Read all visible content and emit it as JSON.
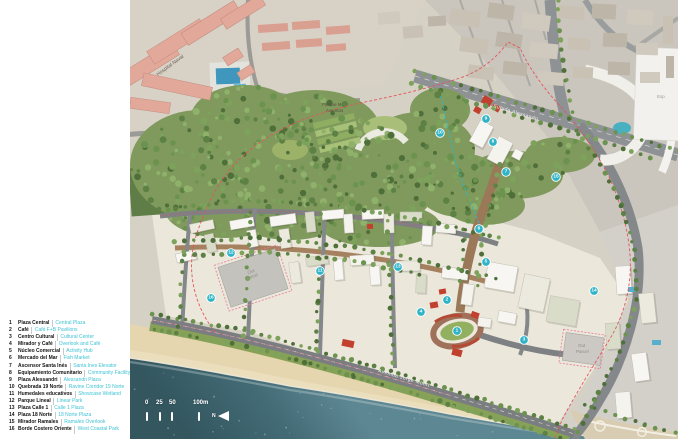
{
  "legend": {
    "items": [
      {
        "num": "1",
        "name": "Plaza Central",
        "en": "Central Plaza"
      },
      {
        "num": "2",
        "name": "Café",
        "en": "Café F+B Pavilions"
      },
      {
        "num": "3",
        "name": "Centro Cultural",
        "en": "Cultural Center"
      },
      {
        "num": "4",
        "name": "Mirador y Café",
        "en": "Overlook and Café"
      },
      {
        "num": "5",
        "name": "Núcleo Comercial",
        "en": "Activity Hub"
      },
      {
        "num": "6",
        "name": "Mercado del Mar",
        "en": "Fish Market"
      },
      {
        "num": "7",
        "name": "Ascensor Santa Inés",
        "en": "Santa Ines Elevator"
      },
      {
        "num": "8",
        "name": "Equipamiento Comunitario",
        "en": "Community Facility"
      },
      {
        "num": "9",
        "name": "Plaza Alessandri",
        "en": "Alessandri Plaza"
      },
      {
        "num": "10",
        "name": "Quebrada 19 Norte",
        "en": "Ravine Corridor 19 Norte"
      },
      {
        "num": "11",
        "name": "Humedales educativos",
        "en": "Showcase Wetland"
      },
      {
        "num": "12",
        "name": "Parque Lineal",
        "en": "Linear Park"
      },
      {
        "num": "13",
        "name": "Plaza Calle 1",
        "en": "Calle 1 Plaza"
      },
      {
        "num": "14",
        "name": "Plaza 18 Norte",
        "en": "18 Norte Plaza"
      },
      {
        "num": "15",
        "name": "Mirador Ramales",
        "en": "Ramales Overlook"
      },
      {
        "num": "16",
        "name": "Borde Costero Oriente",
        "en": "West Coastal Park"
      }
    ]
  },
  "map": {
    "labels": {
      "hospital": "Hospital Naval",
      "parque_line1": "Parque M.",
      "parque_line2": "Asientos",
      "subida": "Subida Alessandri",
      "avenida": "Avenida Jorge Montt",
      "out_parcel_line1": "Out",
      "out_parcel_line2": "Parcel",
      "esp": "Esp"
    },
    "markers": [
      {
        "n": "1",
        "x": 327,
        "y": 331
      },
      {
        "n": "2",
        "x": 317,
        "y": 300
      },
      {
        "n": "3",
        "x": 394,
        "y": 340
      },
      {
        "n": "4",
        "x": 291,
        "y": 312
      },
      {
        "n": "5",
        "x": 356,
        "y": 262
      },
      {
        "n": "6",
        "x": 349,
        "y": 229
      },
      {
        "n": "7",
        "x": 376,
        "y": 172
      },
      {
        "n": "8",
        "x": 363,
        "y": 142
      },
      {
        "n": "9",
        "x": 356,
        "y": 119
      },
      {
        "n": "10",
        "x": 310,
        "y": 133
      },
      {
        "n": "11",
        "x": 190,
        "y": 271
      },
      {
        "n": "12",
        "x": 101,
        "y": 253
      },
      {
        "n": "13",
        "x": 268,
        "y": 267
      },
      {
        "n": "14",
        "x": 464,
        "y": 291
      },
      {
        "n": "15",
        "x": 426,
        "y": 177
      },
      {
        "n": "16",
        "x": 81,
        "y": 298
      }
    ]
  },
  "scalebar": {
    "labels": [
      "0",
      "25",
      "50",
      "100m"
    ],
    "north": "N"
  },
  "colors": {
    "marker": "#2fb4c7",
    "legend_accent": "#3fc3d4",
    "ocean": "#3e6673",
    "beach": "#e6d6b0",
    "forest": "#7f9a5c",
    "red_accent": "#c2402e"
  }
}
